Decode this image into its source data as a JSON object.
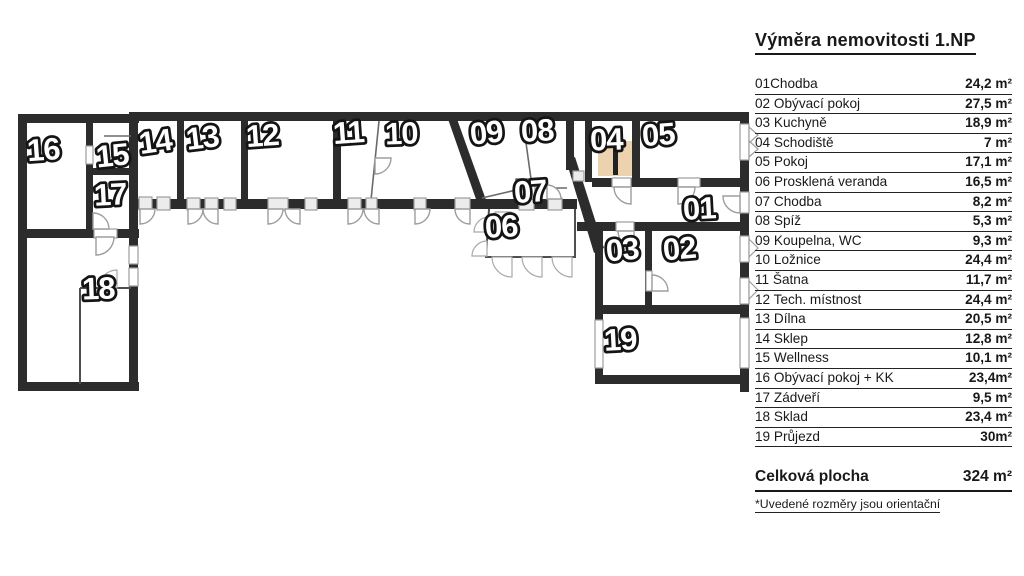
{
  "title": "Výměra nemovitosti 1.NP",
  "legend": {
    "rows": [
      {
        "label": "01Chodba",
        "value": "24,2 m²"
      },
      {
        "label": "02 Obývací pokoj",
        "value": "27,5 m²"
      },
      {
        "label": "03 Kuchyně",
        "value": "18,9 m²"
      },
      {
        "label": "04 Schodiště",
        "value": "7 m²"
      },
      {
        "label": "05 Pokoj",
        "value": "17,1 m²"
      },
      {
        "label": "06 Prosklená veranda",
        "value": "16,5 m²"
      },
      {
        "label": "07 Chodba",
        "value": "8,2 m²"
      },
      {
        "label": "08 Spíž",
        "value": "5,3 m²"
      },
      {
        "label": "09 Koupelna, WC",
        "value": "9,3 m²"
      },
      {
        "label": "10 Ložnice",
        "value": "24,4 m²"
      },
      {
        "label": "11 Šatna",
        "value": "11,7 m²"
      },
      {
        "label": "12 Tech. místnost",
        "value": "24,4 m²"
      },
      {
        "label": "13 Dílna",
        "value": "20,5 m²"
      },
      {
        "label": "14 Sklep",
        "value": "12,8 m²"
      },
      {
        "label": "15 Wellness",
        "value": "10,1 m²"
      },
      {
        "label": "16 Obývací pokoj + KK",
        "value": "23,4m²"
      },
      {
        "label": "17 Zádveří",
        "value": "9,5 m²"
      },
      {
        "label": "18 Sklad",
        "value": "23,4 m²"
      },
      {
        "label": "19 Průjezd",
        "value": "30m²"
      }
    ],
    "total_label": "Celková plocha",
    "total_value": "324 m²",
    "note": "*Uvedené rozměry jsou orientační"
  },
  "plan": {
    "floor": "1.NP",
    "wall_color": "#2c2c2c",
    "stair_color": "#ecd2af",
    "room_labels": {
      "16": "16",
      "15": "15",
      "17": "17",
      "14": "14",
      "13": "13",
      "12": "12",
      "11": "11",
      "10": "10",
      "09": "09",
      "08": "08",
      "04": "04",
      "05": "05",
      "07": "07",
      "06": "06",
      "01": "01",
      "03": "03",
      "02": "02",
      "18": "18",
      "19": "19"
    }
  }
}
